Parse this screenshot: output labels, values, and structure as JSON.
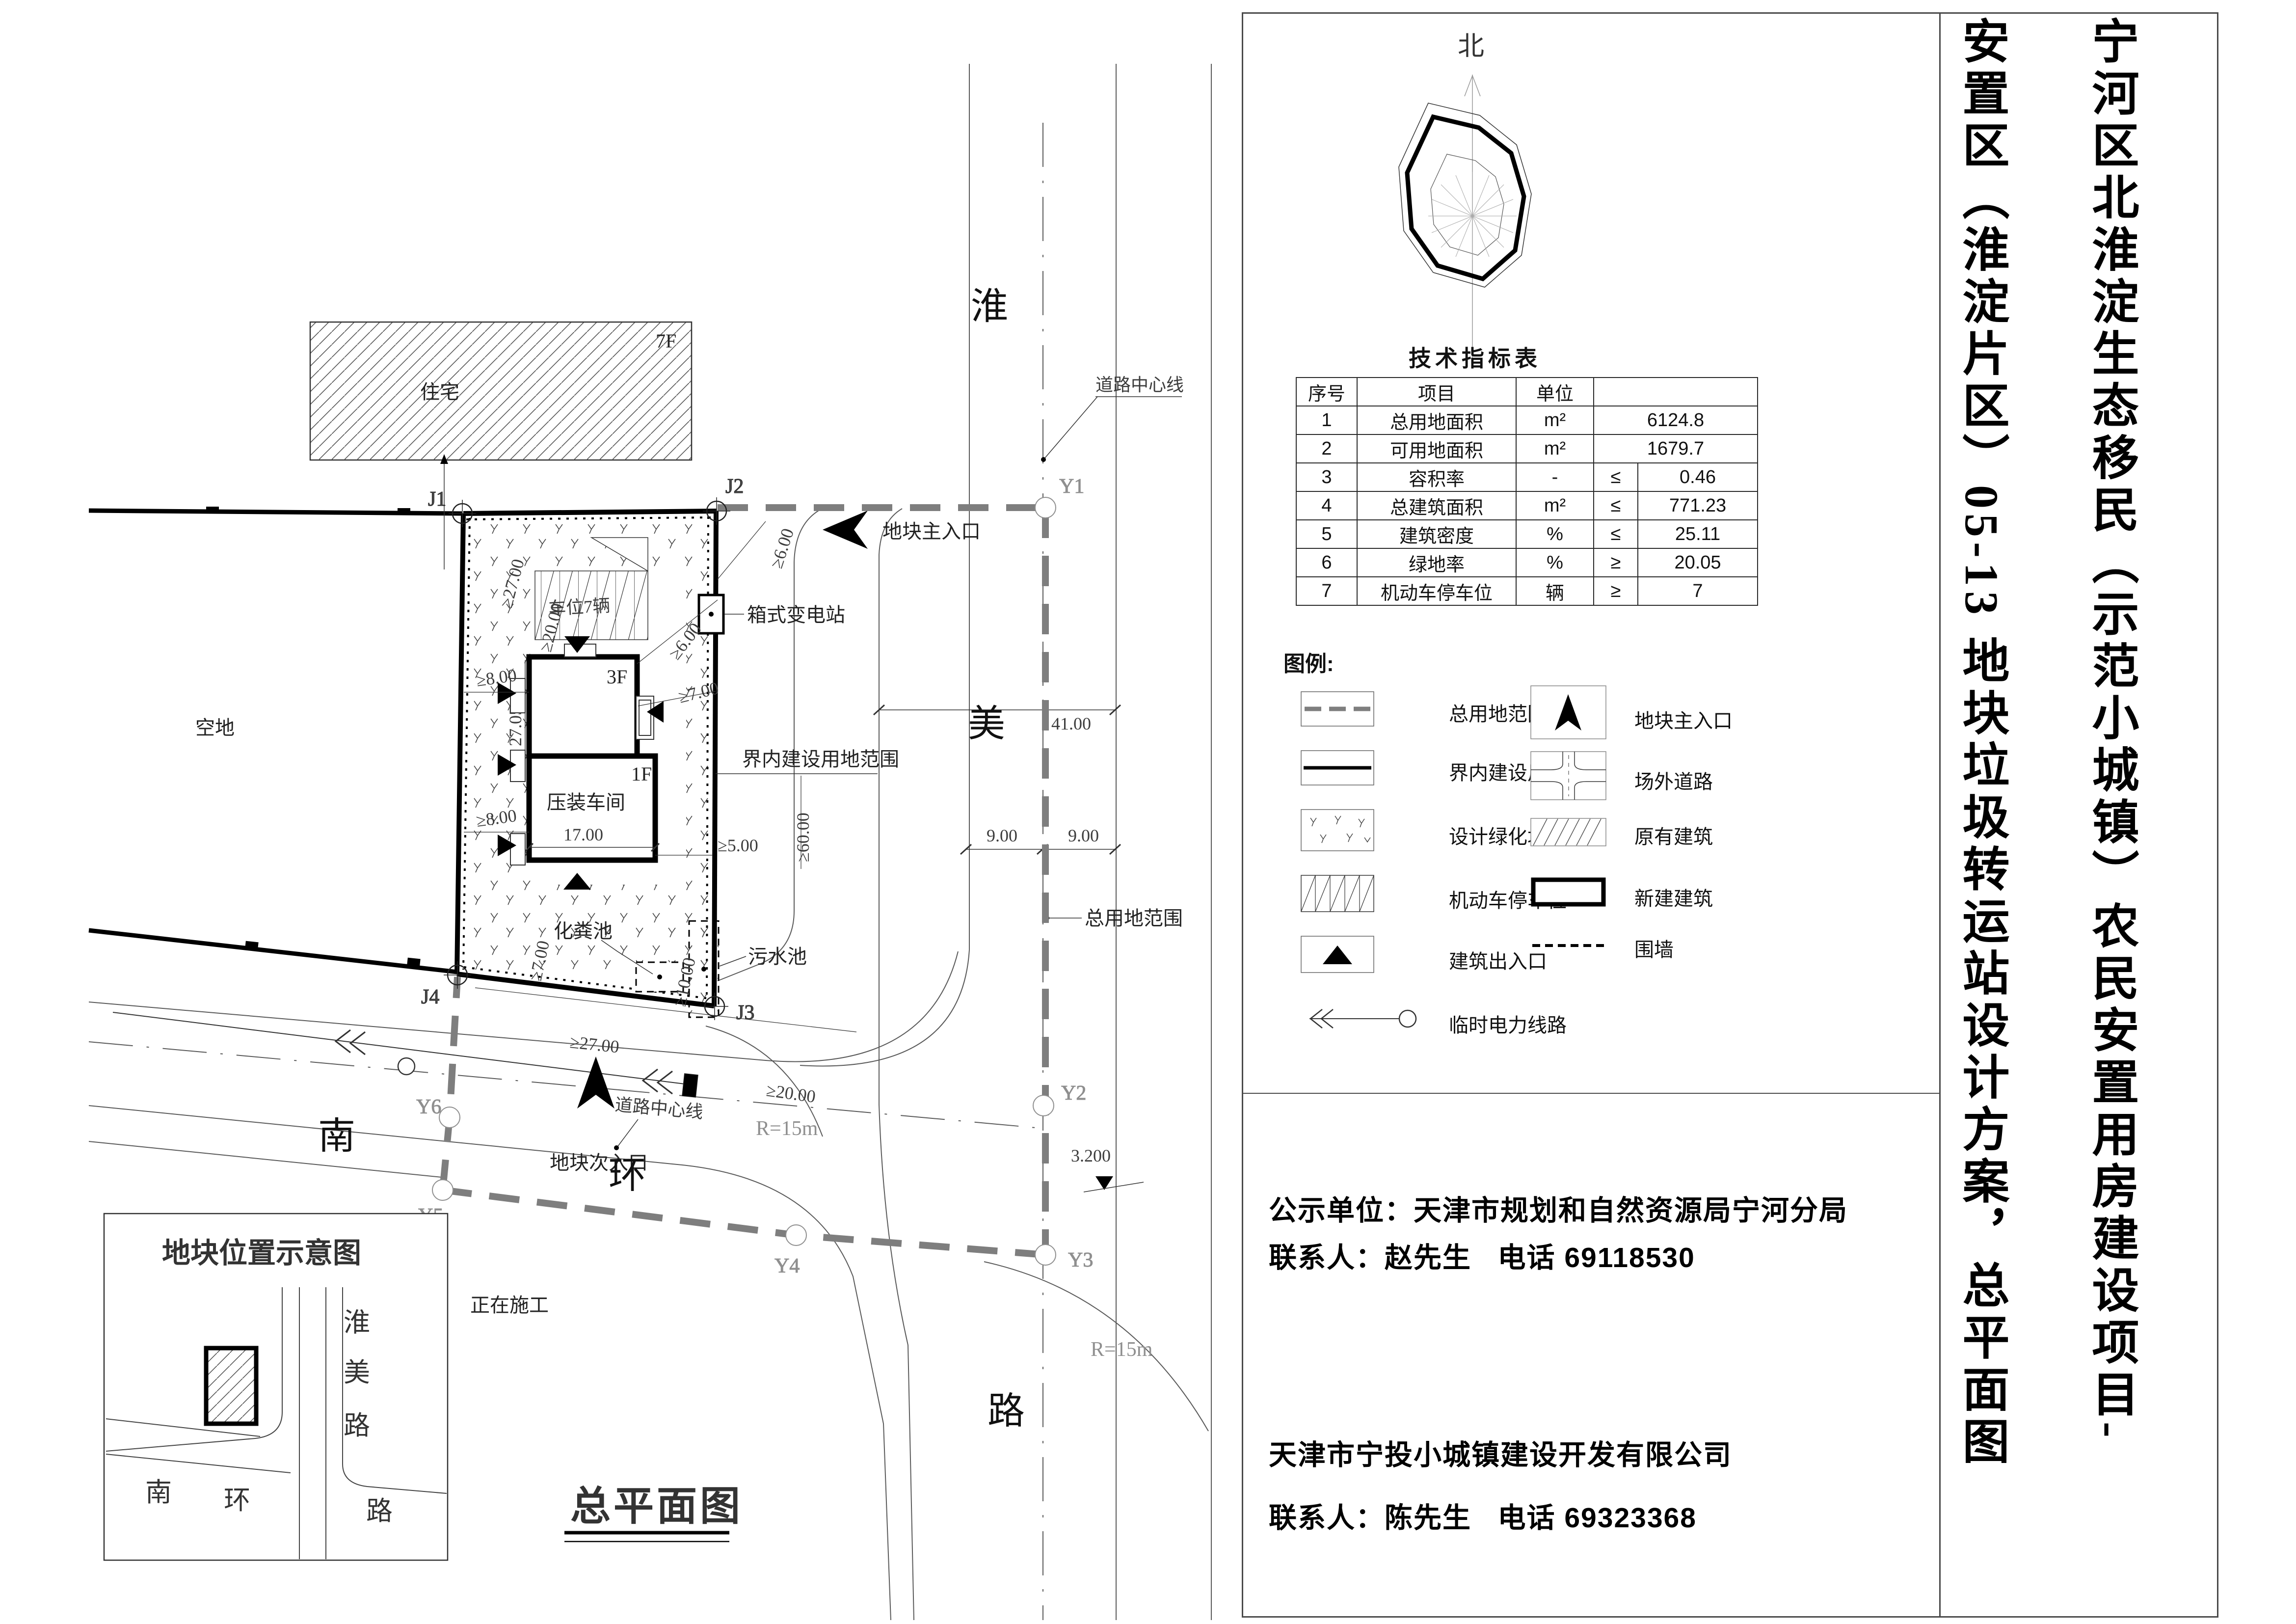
{
  "title_block": {
    "line1": "宁河区北淮淀生态移民（示范小城镇）农民安置用房建设项目-",
    "line2": "安置区（淮淀片区）05-13 地块垃圾转运站设计方案，总平面图"
  },
  "north": {
    "label": "北"
  },
  "tech_table": {
    "title": "技术指标表",
    "headers": {
      "no": "序号",
      "item": "项目",
      "unit": "单位"
    },
    "rows": [
      {
        "no": "1",
        "item": "总用地面积",
        "unit": "m²",
        "cmp": "",
        "value": "6124.8"
      },
      {
        "no": "2",
        "item": "可用地面积",
        "unit": "m²",
        "cmp": "",
        "value": "1679.7"
      },
      {
        "no": "3",
        "item": "容积率",
        "unit": "-",
        "cmp": "≤",
        "value": "0.46"
      },
      {
        "no": "4",
        "item": "总建筑面积",
        "unit": "m²",
        "cmp": "≤",
        "value": "771.23"
      },
      {
        "no": "5",
        "item": "建筑密度",
        "unit": "%",
        "cmp": "≤",
        "value": "25.11"
      },
      {
        "no": "6",
        "item": "绿地率",
        "unit": "%",
        "cmp": "≥",
        "value": "20.05"
      },
      {
        "no": "7",
        "item": "机动车停车位",
        "unit": "辆",
        "cmp": "≥",
        "value": "7"
      }
    ]
  },
  "legend": {
    "title": "图例:",
    "items_left": [
      "总用地范围",
      "界内建设用地范围",
      "设计绿化场地",
      "机动车停车位",
      "建筑出入口",
      "临时电力线路"
    ],
    "items_right": [
      "地块主入口",
      "场外道路",
      "原有建筑",
      "新建建筑",
      "围墙"
    ]
  },
  "notice": {
    "line1": "公示单位：天津市规划和自然资源局宁河分局",
    "line2": "联系人：赵先生   电话 69118530",
    "line3": "天津市宁投小城镇建设开发有限公司",
    "line4": "联系人：陈先生   电话 69323368"
  },
  "plan": {
    "title": "总平面图",
    "labels": {
      "residence": "住宅",
      "residence_floors": "7F",
      "vacant": "空地",
      "under_construction": "正在施工",
      "workshop": "压装车间",
      "workshop_floors_upper": "3F",
      "workshop_floors_lower": "1F",
      "parking": "车位7辆",
      "substation": "箱式变电站",
      "septic": "化粪池",
      "sewage": "污水池",
      "inner_boundary": "界内建设用地范围",
      "outer_boundary": "总用地范围",
      "road_center_top": "道路中心线",
      "road_center_bottom": "道路中心线",
      "main_entrance": "地块主入口",
      "secondary_entrance": "地块次入口"
    },
    "dims": {
      "d27_05": "27.05",
      "d17": "17.00",
      "ge8a": "≥8.00",
      "ge8b": "≥8.00",
      "ge7a": "≥7.00",
      "ge7b": "≥7.00",
      "ge6a": "≥6.00",
      "ge6b": "≥6.00",
      "ge5": "≥5.00",
      "ge60": "≥60.00",
      "ge10": "≥10.00",
      "ge27": "≥27.00",
      "ge20": "≥20.00",
      "d41": "41.00",
      "d9a": "9.00",
      "d9b": "9.00",
      "elev": "3.200",
      "r15a": "R=15m",
      "r15b": "R=15m"
    },
    "markers": {
      "j1": "J1",
      "j2": "J2",
      "j3": "J3",
      "j4": "J4",
      "y1": "Y1",
      "y2": "Y2",
      "y3": "Y3",
      "y4": "Y4",
      "y5": "Y5",
      "y6": "Y6"
    },
    "roads": {
      "huai": "淮",
      "mei": "美",
      "lu1": "路",
      "nan": "南",
      "huan": "环"
    }
  },
  "inset": {
    "title": "地块位置示意图",
    "roads": {
      "huai": "淮",
      "mei": "美",
      "lu1": "路",
      "nan": "南",
      "huan": "环",
      "lu2": "路"
    }
  }
}
